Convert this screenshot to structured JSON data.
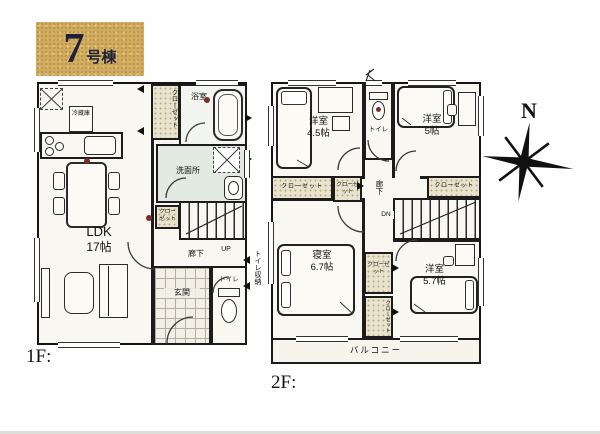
{
  "badge": {
    "number": "7",
    "suffix": "号棟"
  },
  "compass": {
    "north": "N"
  },
  "colors": {
    "wall": "#1c1c1c",
    "closet_fill": "#e9e2cd",
    "washroom_fill": "#e2eae2",
    "badge_bg": "#d0ad62",
    "alarm_dot": "#7b2d26"
  },
  "floor1": {
    "label": "1F:",
    "ldk_name": "LDK",
    "ldk_size": "17帖",
    "closet_tall": "クローゼット",
    "bath": "浴室",
    "washroom": "洗面所",
    "fridge": "冷蔵庫",
    "hall": "廊下",
    "closet_hall": "クローゼット",
    "up": "UP",
    "toilet": "トイレ",
    "entrance": "玄関",
    "toilet_storage": "トイレ収納"
  },
  "floor2": {
    "label": "2F:",
    "room_nw_name": "洋室",
    "room_nw_size": "4.5帖",
    "room_ne_name": "洋室",
    "room_ne_size": "5帖",
    "bedroom_name": "寝室",
    "bedroom_size": "6.7帖",
    "room_se_name": "洋室",
    "room_se_size": "5.7帖",
    "toilet": "トイレ",
    "hall": "廊下",
    "closet_w": "クローゼット",
    "closet_mid": "クローゼット",
    "closet_e": "クローゼット",
    "closet_c1": "クローゼット",
    "closet_c2": "クローゼット",
    "dn": "DN",
    "balcony": "バルコニー"
  }
}
